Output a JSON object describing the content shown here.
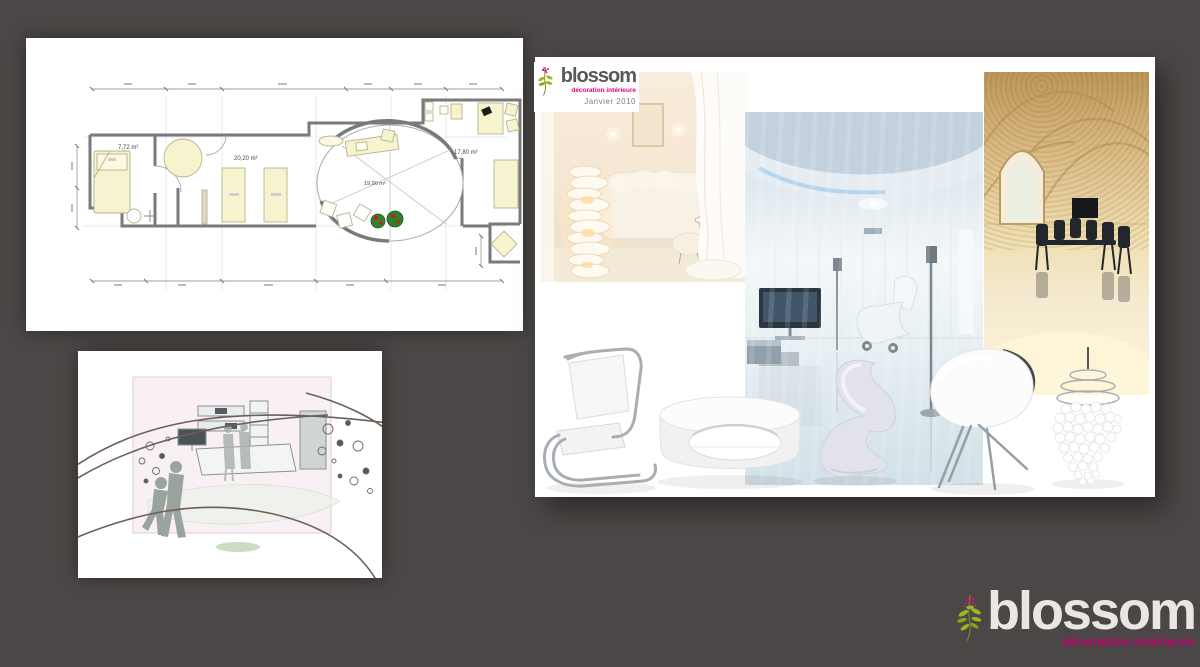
{
  "colors": {
    "background": "#4b4746",
    "accent_pink": "#e5007d",
    "tagline_magenta": "#c0006e",
    "leaf_green": "#9cb525",
    "plan_furniture": "#f6f3cf"
  },
  "floorplan": {
    "room_labels": [
      "7,72 m²",
      "20,20 m²",
      "19,90 m²",
      "17,80 m²"
    ]
  },
  "moodboard": {
    "header": {
      "brand": "blossom",
      "tagline": "décoration intérieure",
      "date": "Janvier 2010"
    },
    "images": [
      "white-living-room-photo",
      "glossy-white-loft-photo",
      "stone-vault-dining-photo"
    ],
    "furniture": [
      "cantilever-chair",
      "oval-coffee-table",
      "panton-chair",
      "tub-chair",
      "shell-chandelier"
    ]
  },
  "footer_logo": {
    "brand": "blossom",
    "tagline": "décoration intérieure"
  }
}
